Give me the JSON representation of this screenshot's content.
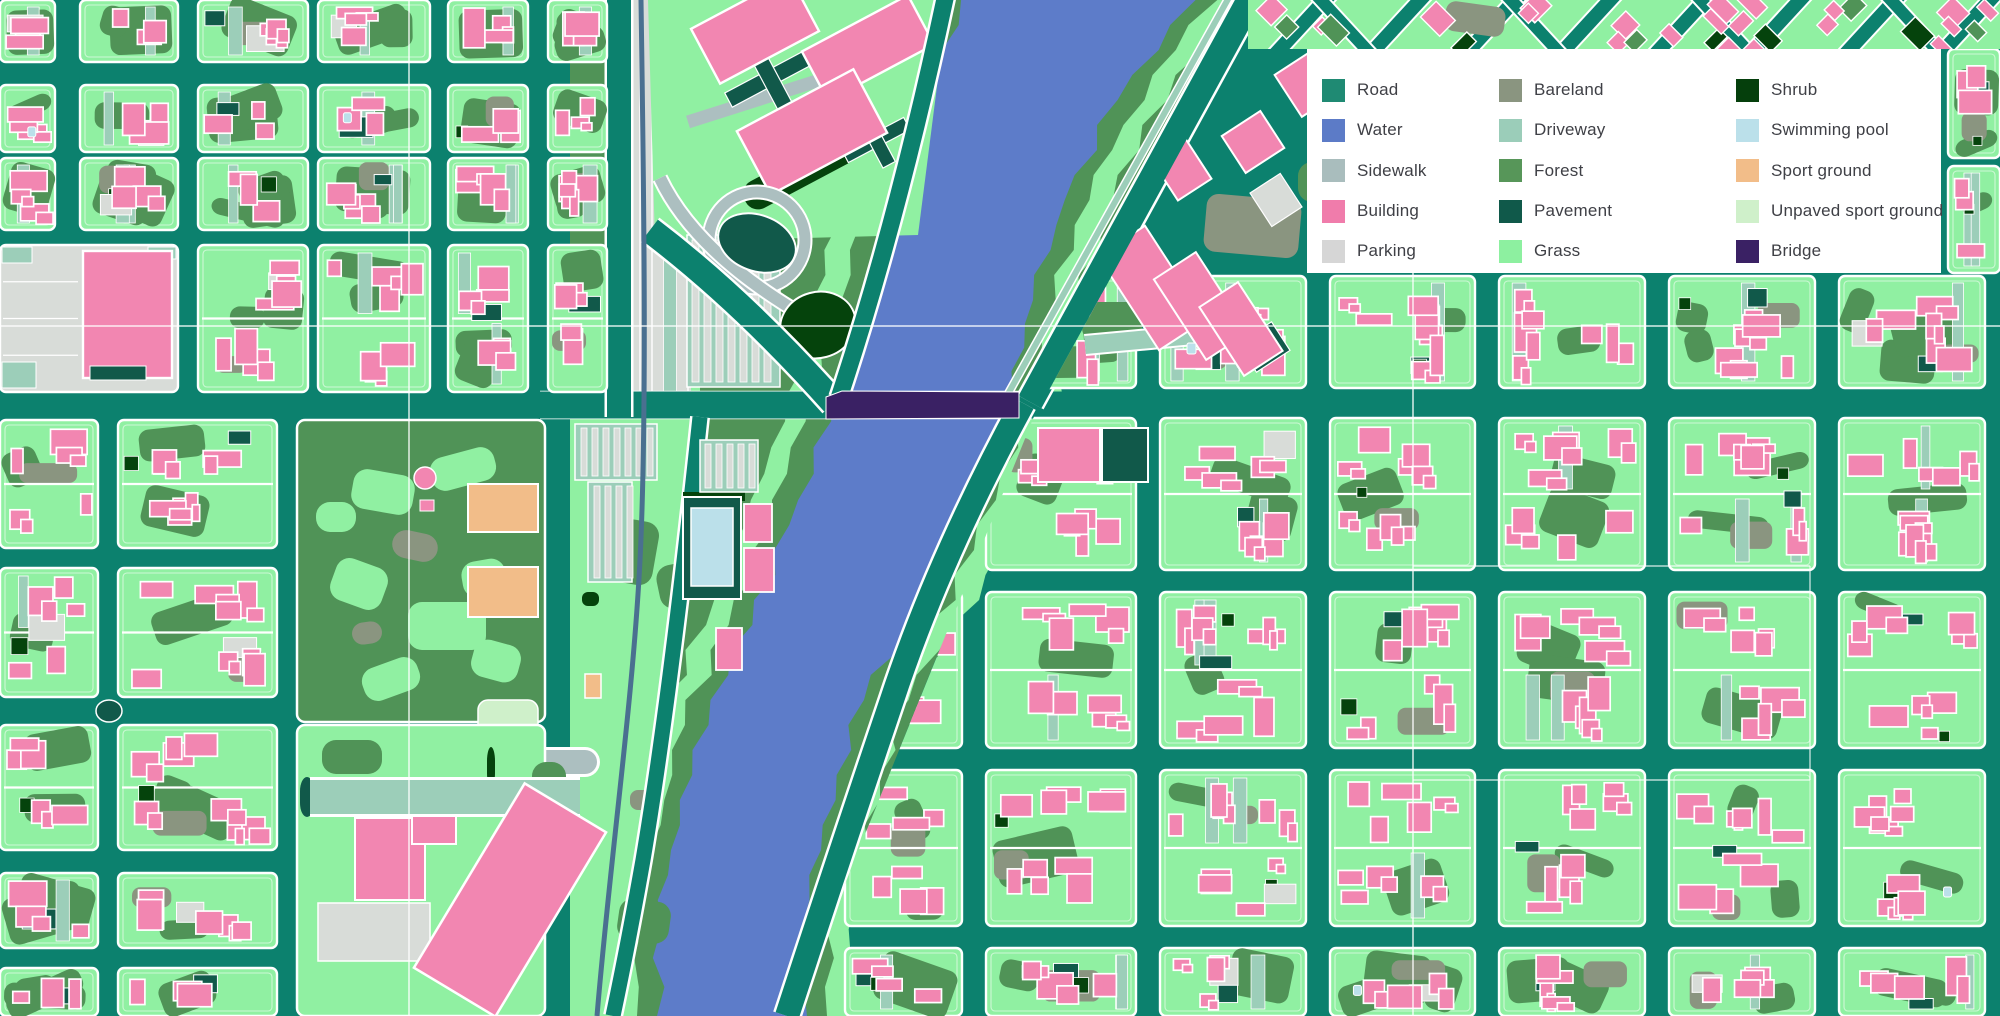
{
  "legend": {
    "background": "#ffffff",
    "text_color": "#3f4046",
    "panel": {
      "x": 1307,
      "y": 49,
      "width": 634,
      "height": 224
    },
    "column_offsets": [
      15,
      192,
      429
    ],
    "columns": [
      [
        {
          "label": "Road",
          "color": "#1f8a73"
        },
        {
          "label": "Water",
          "color": "#5c7bc7"
        },
        {
          "label": "Sidewalk",
          "color": "#a9bdbd"
        },
        {
          "label": "Building",
          "color": "#f07cab"
        },
        {
          "label": "Parking",
          "color": "#d6d6d6"
        }
      ],
      [
        {
          "label": "Bareland",
          "color": "#8a9580"
        },
        {
          "label": "Driveway",
          "color": "#9bcdb9"
        },
        {
          "label": "Forest",
          "color": "#579659"
        },
        {
          "label": "Pavement",
          "color": "#10594a"
        },
        {
          "label": "Grass",
          "color": "#8df0a0"
        }
      ],
      [
        {
          "label": "Shrub",
          "color": "#053f0c"
        },
        {
          "label": "Swimming pool",
          "color": "#bbe0ea"
        },
        {
          "label": "Sport ground",
          "color": "#f2bd89"
        },
        {
          "label": "Unpaved sport ground",
          "color": "#cff0ca"
        },
        {
          "label": "Bridge",
          "color": "#3a2164"
        }
      ]
    ]
  },
  "map": {
    "width": 2000,
    "height": 1016,
    "colors": {
      "road": "#0c816e",
      "grass": "#90f0a2",
      "forest": "#509357",
      "pavement": "#11594a",
      "shrub": "#05430c",
      "building": "#f286b1",
      "sidewalk": "#acbfc0",
      "driveway": "#9cceb9",
      "parking": "#d8dcd8",
      "bareland": "#8a9580",
      "water": "#5d7cc9",
      "pool": "#bbe0ea",
      "sport": "#f2bd89",
      "unpaved": "#cff0ca",
      "bridge": "#3a2164",
      "rail": "#4a7090",
      "outline": "#ffffff"
    },
    "central_strip": [
      [
        570,
        0
      ],
      [
        1255,
        0
      ],
      [
        1032,
        398
      ],
      [
        1032,
        420
      ],
      [
        792,
        1016
      ],
      [
        570,
        1016
      ]
    ],
    "river": {
      "points": [
        [
          0,
          1081,
          114
        ],
        [
          100,
          1022,
          96
        ],
        [
          200,
          975,
          90
        ],
        [
          300,
          948,
          85
        ],
        [
          395,
          922,
          89
        ],
        [
          500,
          887,
          88
        ],
        [
          600,
          845,
          85
        ],
        [
          700,
          786,
          74
        ],
        [
          800,
          757,
          72
        ],
        [
          900,
          733,
          75
        ],
        [
          1016,
          732,
          75
        ]
      ],
      "grass_halo": 44,
      "forest_halo": 20
    },
    "sections": [
      {
        "name": "top-left",
        "cols": [
          [
            0,
            55
          ],
          [
            80,
            178
          ],
          [
            198,
            308
          ],
          [
            318,
            430
          ],
          [
            448,
            528
          ],
          [
            548,
            607
          ]
        ],
        "rows": [
          [
            0,
            62
          ],
          [
            85,
            152
          ],
          [
            158,
            230
          ],
          [
            245,
            392
          ]
        ],
        "special": {
          "3,0": "skip",
          "3,1": "skip"
        }
      },
      {
        "name": "bottom-left",
        "cols": [
          [
            0,
            98
          ],
          [
            118,
            277
          ]
        ],
        "rows": [
          [
            420,
            548
          ],
          [
            568,
            697
          ],
          [
            725,
            850
          ],
          [
            873,
            948
          ],
          [
            968,
            1016
          ]
        ]
      },
      {
        "name": "right-grid",
        "clip": "rightGrid",
        "cols": [
          [
            845,
            962
          ],
          [
            986,
            1136
          ],
          [
            1160,
            1306
          ],
          [
            1330,
            1475
          ],
          [
            1499,
            1645
          ],
          [
            1669,
            1815
          ],
          [
            1839,
            1985
          ]
        ],
        "rows": [
          [
            418,
            570
          ],
          [
            592,
            748
          ],
          [
            770,
            926
          ],
          [
            948,
            1016
          ]
        ]
      },
      {
        "name": "right-mid",
        "clip": "northEast",
        "cols": [
          [
            1040,
            1136
          ],
          [
            1160,
            1306
          ],
          [
            1330,
            1475
          ],
          [
            1499,
            1645
          ],
          [
            1669,
            1815
          ],
          [
            1839,
            1985
          ]
        ],
        "rows": [
          [
            276,
            388
          ]
        ]
      },
      {
        "name": "right-of-legend",
        "cols": [
          [
            1948,
            2000
          ]
        ],
        "rows": [
          [
            49,
            158
          ],
          [
            166,
            273
          ]
        ]
      }
    ],
    "clips": {
      "rightGrid": [
        [
          1035,
          414
        ],
        [
          2005,
          414
        ],
        [
          2005,
          1020
        ],
        [
          790,
          1020
        ]
      ],
      "northEast": [
        [
          1037,
          412
        ],
        [
          1266,
          -5
        ],
        [
          2005,
          -5
        ],
        [
          2005,
          412
        ]
      ]
    },
    "roads": {
      "majorWest": {
        "d": "M0,405 H833",
        "w": 27
      },
      "majorEast": {
        "d": "M1012,405 H2000",
        "w": 27
      },
      "r1": {
        "d": "M650,230 Q742,300 834,403",
        "w": 26
      },
      "r2": {
        "d": "M946,-6 Q898,220 839,398",
        "w": 17
      },
      "r3": {
        "d": "M700,417 Q670,700 643,860 Q628,945 613,1016",
        "w": 15
      },
      "r4": {
        "d": "M1023,403 Q938,560 892,700 Q838,860 787,1016",
        "w": 24
      },
      "r5": {
        "d": "M1030,402 L1253,-6",
        "w": 26
      },
      "corridor": {
        "d": "M619,0 V417",
        "w": 24
      },
      "sideLane": {
        "d": "M1008,394 L1232,-8",
        "w": 6
      },
      "rail": {
        "d": "M641,0 C644,200 647,420 640,560 C633,700 610,860 597,1016",
        "w": 5
      }
    },
    "graticule": {
      "color": "rgba(255,255,255,0.85)",
      "verticals": [
        {
          "x": 409,
          "y1": 0,
          "y2": 1016
        },
        {
          "x": 1413,
          "y1": 273,
          "y2": 1016
        }
      ],
      "horizontals": [
        {
          "y": 326,
          "x1": 0,
          "x2": 2000
        }
      ],
      "segments": [
        [
          1413,
          566,
          1810,
          566
        ],
        [
          1413,
          780,
          1810,
          780
        ],
        [
          1810,
          566,
          1810,
          780
        ]
      ]
    },
    "features": {
      "bigPinkBlock": {
        "rect": [
          0,
          245,
          178,
          147
        ],
        "pink": [
          83,
          251,
          89,
          127
        ],
        "pavement": [
          90,
          366,
          56,
          14
        ],
        "driveway": [
          [
            2,
            247,
            30,
            16
          ],
          [
            148,
            247,
            28,
            12
          ],
          [
            2,
            362,
            34,
            26
          ]
        ]
      },
      "corridorStripes": {
        "rect": [
          632,
          0,
          68,
          418
        ]
      },
      "wedge": {
        "poly": [
          [
            570,
            418
          ],
          [
            702,
            418
          ],
          [
            674,
            700
          ],
          [
            642,
            880
          ],
          [
            614,
            1016
          ],
          [
            570,
            1016
          ]
        ],
        "stripes": [
          [
            575,
            424,
            82,
            56
          ],
          [
            588,
            482,
            44,
            100
          ]
        ],
        "orange": [
          585,
          674,
          16,
          24
        ],
        "pink": [
          716,
          628,
          26,
          42
        ],
        "shrub": [
          582,
          592,
          17,
          14
        ],
        "bareland": [
          630,
          790,
          26,
          20
        ],
        "forest": [
          [
            612,
            520,
            44,
            64,
            10
          ],
          [
            658,
            564,
            36,
            44,
            -12
          ],
          [
            618,
            900,
            52,
            42,
            8
          ]
        ]
      },
      "park": {
        "base": [
          297,
          420,
          248,
          302
        ],
        "grass": [
          [
            352,
            472,
            62,
            40,
            10
          ],
          [
            430,
            452,
            66,
            34,
            -15
          ],
          [
            332,
            562,
            54,
            44,
            20
          ],
          [
            408,
            602,
            78,
            48,
            0
          ],
          [
            362,
            662,
            58,
            34,
            -20
          ],
          [
            472,
            642,
            48,
            38,
            15
          ],
          [
            316,
            502,
            40,
            30,
            0
          ],
          [
            462,
            560,
            44,
            36,
            -10
          ]
        ],
        "bareland": [
          [
            392,
            532,
            46,
            28,
            12
          ],
          [
            352,
            622,
            30,
            22,
            -8
          ]
        ],
        "orange": [
          [
            468,
            484,
            70,
            48
          ],
          [
            468,
            567,
            70,
            50
          ]
        ],
        "unpaved": [
          478,
          700,
          60,
          44
        ],
        "pinkDot": [
          425,
          478,
          11
        ],
        "pinkRect": [
          420,
          500,
          14,
          11
        ],
        "ring": {
          "c": [
            442,
            762
          ],
          "r": 13,
          "stem": [
            [
              455,
              762
            ],
            [
              585,
              762
            ]
          ]
        }
      },
      "parkSouth": {
        "base": [
          297,
          725,
          248,
          291
        ],
        "shrub": [
          [
            310,
            783,
            22,
            28
          ],
          [
            487,
            747,
            8,
            40
          ]
        ],
        "pavement": [
          [
            300,
            777,
            14,
            40
          ]
        ],
        "forest": [
          [
            322,
            740,
            60,
            34,
            0
          ],
          [
            532,
            762,
            34,
            56,
            0
          ]
        ],
        "pinkA": [
          355,
          818,
          70,
          82
        ],
        "pinkSmall": [
          412,
          816,
          44,
          28
        ],
        "parkingBig": [
          318,
          903,
          112,
          58
        ],
        "diagPink": {
          "c": [
            510,
            900
          ],
          "w": 95,
          "h": 215,
          "rot": 31
        },
        "driveBand": [
          [
            310,
            797
          ],
          [
            580,
            797
          ]
        ]
      },
      "complex": {
        "base": [
          [
            648,
            0
          ],
          [
            948,
            0
          ],
          [
            918,
            235
          ],
          [
            655,
            242
          ]
        ],
        "buildings": [
          [
            755,
            30,
            112,
            62
          ],
          [
            868,
            48,
            120,
            56
          ],
          [
            812,
            132,
            132,
            72
          ]
        ],
        "rot": -28,
        "pavement": [
          [
            770,
            78,
            94,
            16
          ],
          [
            770,
            78,
            16,
            72
          ],
          [
            876,
            140,
            70,
            14
          ],
          [
            876,
            140,
            14,
            56
          ]
        ],
        "shrubSlab": [
          800,
          172,
          124,
          30
        ],
        "drivePath": [
          [
            688,
            122
          ],
          [
            908,
            52
          ]
        ],
        "parkingStrips": [
          687,
          235,
          93,
          152
        ]
      },
      "interchange": {
        "ringC": [
          757,
          240
        ],
        "ringR": 48,
        "ramp": [
          [
            660,
            178
          ],
          [
            700,
            262
          ],
          [
            833,
            332
          ]
        ],
        "pavementBlob": [
          757,
          243,
          40,
          28,
          20
        ],
        "shrubBlob": [
          818,
          325,
          38,
          33,
          -15
        ]
      },
      "pool": {
        "frame": [
          683,
          497,
          58,
          102
        ],
        "water": [
          691,
          508,
          42,
          78
        ],
        "shrubTop": [
          683,
          492,
          62,
          9
        ],
        "pinks": [
          [
            744,
            504,
            28,
            38
          ],
          [
            744,
            548,
            30,
            44
          ]
        ]
      },
      "stripMall": [
        700,
        440,
        58,
        52
      ],
      "neTriangle": {
        "bareland": [
          1205,
          197,
          95,
          58,
          5
        ],
        "rot": -33,
        "pinks": [
          [
            1124,
            232,
            56,
            112
          ],
          [
            1176,
            258,
            50,
            96
          ],
          [
            1218,
            288,
            46,
            82
          ],
          [
            1160,
            140,
            40,
            54
          ],
          [
            1230,
            120,
            46,
            44
          ],
          [
            1285,
            60,
            40,
            50
          ]
        ],
        "pavement": [
          [
            1244,
            330,
            40,
            34
          ],
          [
            1195,
            302,
            20,
            40
          ]
        ],
        "parking": [
          [
            1258,
            180,
            36,
            40
          ]
        ],
        "forest": [
          [
            1082,
            302,
            60,
            40,
            0
          ],
          [
            1298,
            162,
            40,
            40,
            0
          ]
        ],
        "driveBand": [
          [
            1085,
            345
          ],
          [
            1248,
            330
          ]
        ],
        "pool": [
          1187,
          343,
          9,
          11
        ]
      },
      "diagStrip": {
        "rect": [
          1248,
          0,
          752,
          49
        ]
      },
      "landmarkPink": [
        1038,
        428,
        62,
        54
      ],
      "landmarkPave": [
        1102,
        428,
        46,
        54
      ],
      "roundaboutDot": [
        109,
        711,
        13,
        11
      ],
      "bridge": {
        "poly": [
          [
            826,
            397
          ],
          [
            842,
            391
          ],
          [
            1019,
            392
          ],
          [
            1019,
            418
          ],
          [
            826,
            419
          ]
        ]
      }
    }
  }
}
